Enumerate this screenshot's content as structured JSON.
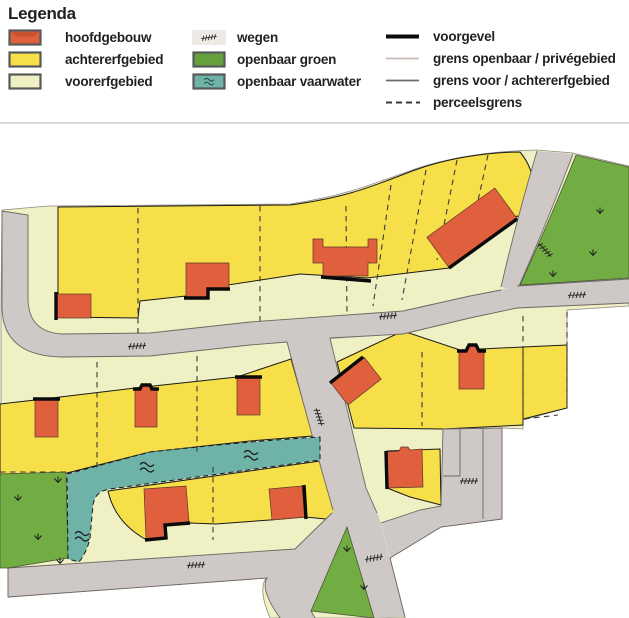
{
  "legend": {
    "title": "Legenda",
    "fill_items": [
      {
        "label": "hoofdgebouw",
        "icon": "building-swatch"
      },
      {
        "label": "achtererfgebied",
        "icon": "backyard-swatch"
      },
      {
        "label": "voorerfgebied",
        "icon": "frontyard-swatch"
      },
      {
        "label": "wegen",
        "icon": "road-swatch"
      },
      {
        "label": "openbaar groen",
        "icon": "green-swatch"
      },
      {
        "label": "openbaar vaarwater",
        "icon": "water-swatch"
      }
    ],
    "line_items": [
      {
        "label": "voorgevel",
        "icon": "thick-black-line"
      },
      {
        "label": "grens openbaar / privégebied",
        "icon": "light-gray-line"
      },
      {
        "label": "grens voor / achtererfgebied",
        "icon": "dark-gray-line"
      },
      {
        "label": "perceelsgrens",
        "icon": "dashed-line"
      }
    ]
  },
  "map": {
    "symbols": {
      "road_mark": "road-hatch-icon",
      "water_mark": "water-wave-icon",
      "grass_mark": "grass-icon"
    }
  },
  "colors": {
    "hoofdgebouw": "#e05f3c",
    "achtererfgebied": "#f6df49",
    "voorerfgebied": "#eff0c4",
    "wegen": "#cec8c6",
    "wegen_legend": "#edeae6",
    "openbaar_groen": "#72ad43",
    "openbaar_vaarwater": "#6fb3a8",
    "voorgevel": "#0a0a0a",
    "grens_openbaar_prive": "#c7bab4",
    "grens_voor_achter": "#6e6a66",
    "perceelsgrens": "#3a3a3a",
    "road_edge": "#6d6862",
    "outline": "#1a1a1a"
  }
}
